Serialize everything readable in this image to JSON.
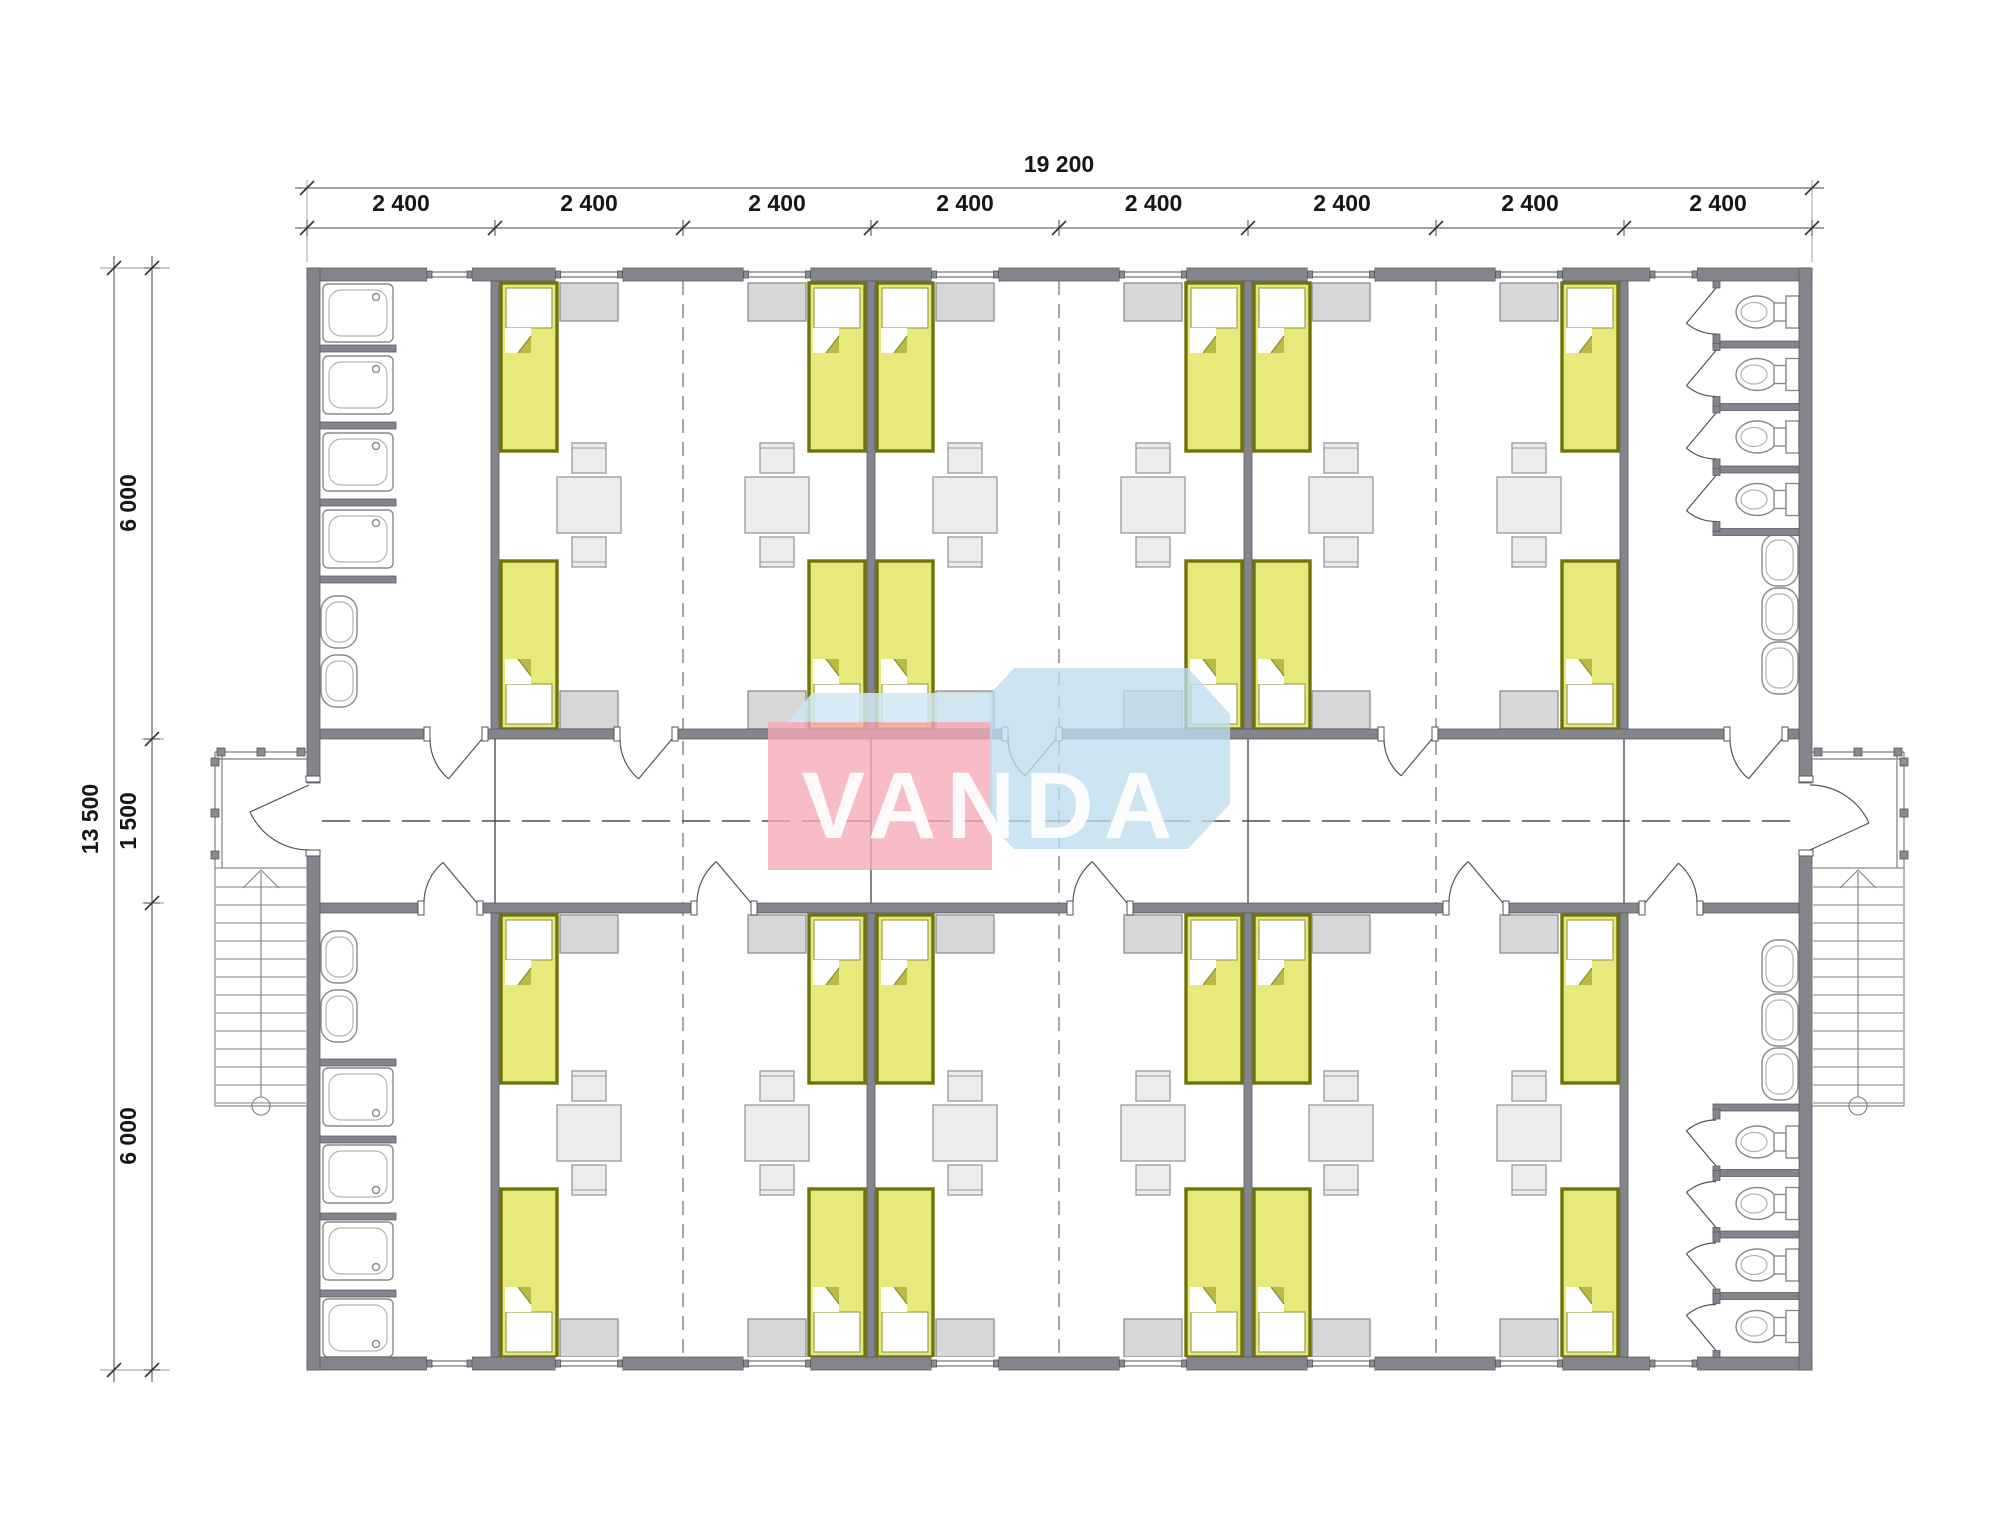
{
  "watermark": {
    "text": "VANDA",
    "front_color": "#f5a9b5",
    "side_color": "#bedcee",
    "top_color": "#cfe7f4",
    "text_color": "#ffffff"
  },
  "dimensions": {
    "top_total": "19 200",
    "top_segments": [
      "2 400",
      "2 400",
      "2 400",
      "2 400",
      "2 400",
      "2 400",
      "2 400",
      "2 400"
    ],
    "left_total": "13 500",
    "left_segments": [
      "6 000",
      "1 500",
      "6 000"
    ]
  },
  "plan": {
    "type": "floor-plan",
    "building_width_mm": 19200,
    "building_depth_mm": 13500,
    "module_width_mm": 2400,
    "wing_depth_mm": 6000,
    "corridor_width_mm": 1500,
    "rooms": {
      "bedrooms": 6,
      "shower_rooms": 2,
      "toilet_rooms": 2,
      "entrance_porches": 2,
      "stair_flights": 2
    },
    "fixtures": {
      "beds": 24,
      "tables": 12,
      "stools": 24,
      "lockers": 24,
      "shower_trays": 8,
      "wash_basins": 10,
      "toilets": 8,
      "windows": 16,
      "room_doors": 10,
      "entrance_doors": 2
    }
  }
}
